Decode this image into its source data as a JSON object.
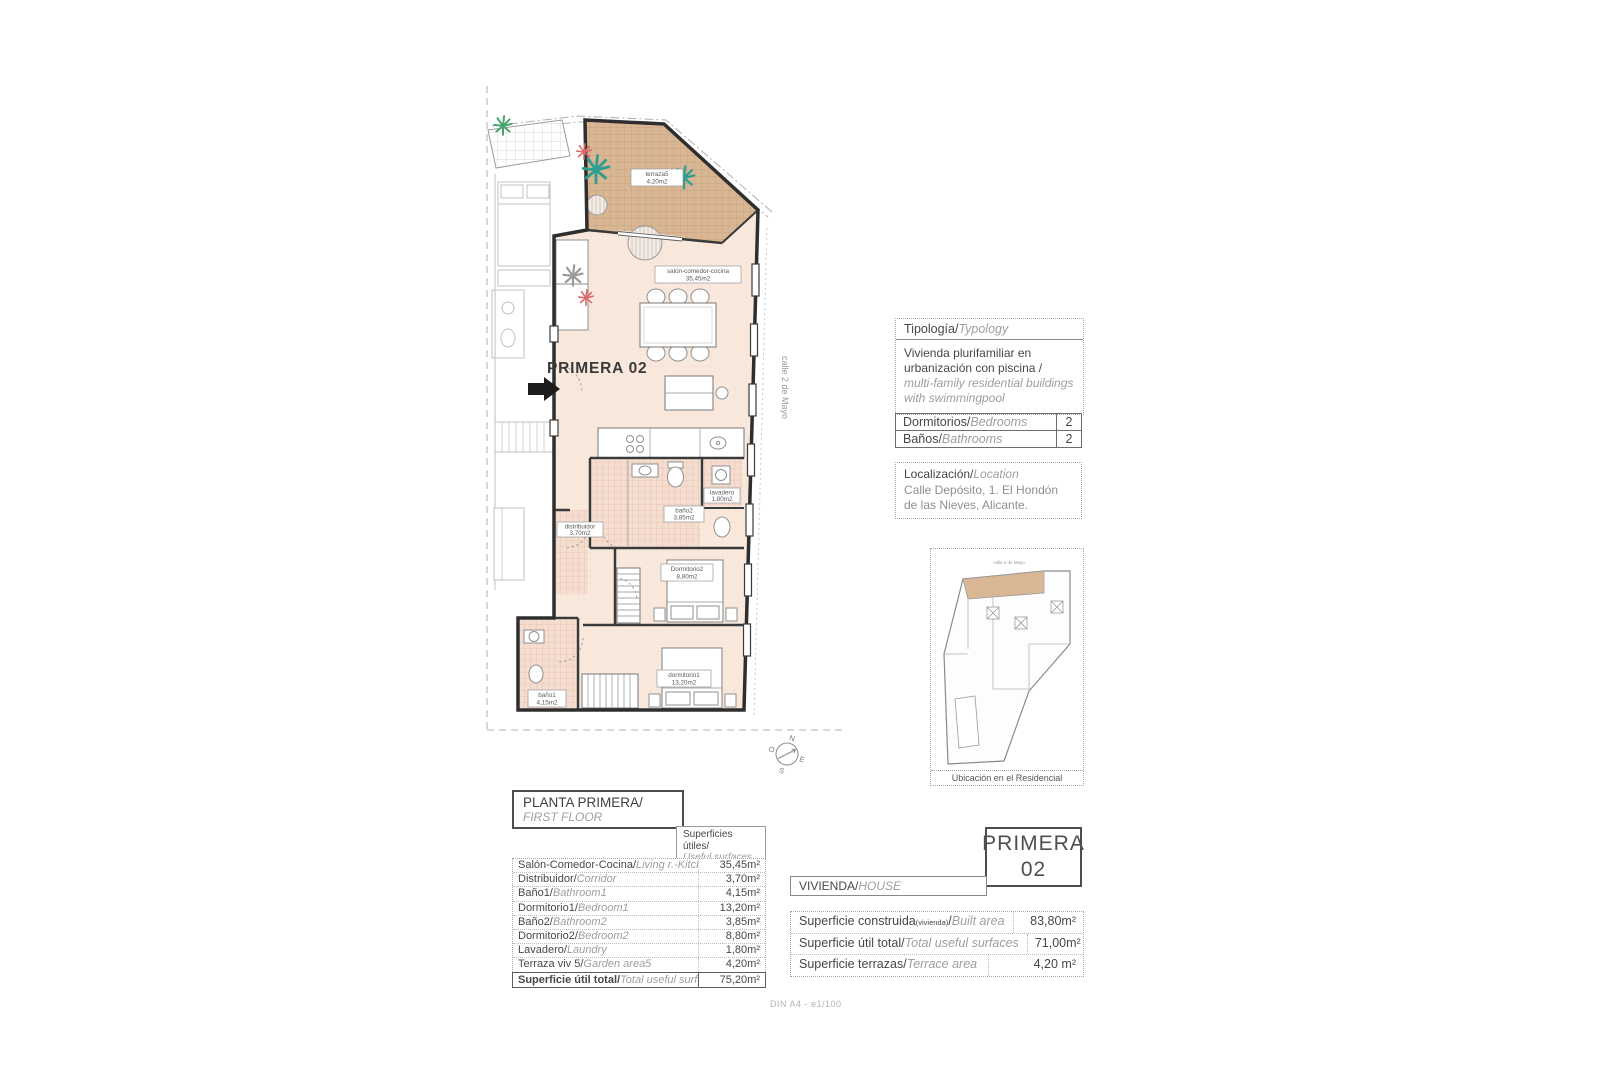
{
  "plan": {
    "unit_label": "PRIMERA 02",
    "street": "calle 2 de Mayo",
    "compass": {
      "n": "N",
      "e": "E",
      "s": "S",
      "w": "O"
    },
    "labels": {
      "terraza": {
        "name": "terraza5",
        "area": "4,20m2"
      },
      "salon": {
        "name": "salón-comedor-cocina",
        "area": "35,45m2"
      },
      "bano2": {
        "name": "baño2",
        "area": "3,85m2"
      },
      "lavadero": {
        "name": "lavadero",
        "area": "1,80m2"
      },
      "distribuidor": {
        "name": "distribuidor",
        "area": "3,70m2"
      },
      "dormitorio2": {
        "name": "Dormitorio2",
        "area": "8,80m2"
      },
      "dormitorio1": {
        "name": "dormitorio1",
        "area": "13,20m2"
      },
      "bano1": {
        "name": "baño1",
        "area": "4,15m2"
      }
    }
  },
  "typology": {
    "header_es": "Tipología/",
    "header_en": "Typology",
    "body_es": "Vivienda plurifamiliar en urbanización con piscina  /",
    "body_en": "multi-family residential buildings with swimmingpool"
  },
  "rooms_table": {
    "rows": [
      {
        "es": "Dormitorios/",
        "en": "Bedrooms",
        "value": "2"
      },
      {
        "es": "Baños/",
        "en": "Bathrooms",
        "value": "2"
      }
    ]
  },
  "location": {
    "header_es": "Localización/",
    "header_en": "Location",
    "address": "Calle Depósito, 1. El Hondón de las Nieves, Alicante."
  },
  "siteplan": {
    "street_top": "calle 2 de Mayo",
    "caption": "Ubicación en el Residencial"
  },
  "floor_header": {
    "title_es": "PLANTA PRIMERA/",
    "title_en": "FIRST FLOOR",
    "col_es": "Superficies útiles/",
    "col_en": "Useful surfaces"
  },
  "useful_table": {
    "rows": [
      {
        "es": "Salón-Comedor-Cocina/",
        "en": "Living r.-Kitchen",
        "value": "35,45m²"
      },
      {
        "es": "Distribuidor/",
        "en": "Corridor",
        "value": "3,70m²"
      },
      {
        "es": "Baño1/",
        "en": "Bathroom1",
        "value": "4,15m²"
      },
      {
        "es": "Dormitorio1/",
        "en": "Bedroom1",
        "value": "13,20m²"
      },
      {
        "es": "Baño2/",
        "en": "Bathroom2",
        "value": "3,85m²"
      },
      {
        "es": "Dormitorio2/",
        "en": "Bedroom2",
        "value": "8,80m²"
      },
      {
        "es": "Lavadero/",
        "en": "Laundry",
        "value": "1,80m²"
      },
      {
        "es": "Terraza viv 5/",
        "en": "Garden area5",
        "value": "4,20m²"
      }
    ],
    "total": {
      "es": "Superficie útil total/",
      "en": "Total useful surface",
      "value": "75,20m²"
    }
  },
  "unit_box": {
    "line1": "PRIMERA",
    "line2": "02"
  },
  "vivienda": {
    "es": "VIVIENDA/",
    "en": "HOUSE"
  },
  "summary_table": {
    "rows": [
      {
        "es": "Superficie construida",
        "sub": "(vivienda)",
        "slash": "/",
        "en": "Built area",
        "value": "83,80m²"
      },
      {
        "es": "Superficie útil total",
        "sub": "",
        "slash": "/",
        "en": "Total useful surfaces",
        "value": "71,00m²"
      },
      {
        "es": "Superficie terrazas",
        "sub": "",
        "slash": "/",
        "en": "Terrace area",
        "value": "4,20 m²"
      }
    ]
  },
  "footer": {
    "scale_note": "DIN A4 - e1/100"
  }
}
